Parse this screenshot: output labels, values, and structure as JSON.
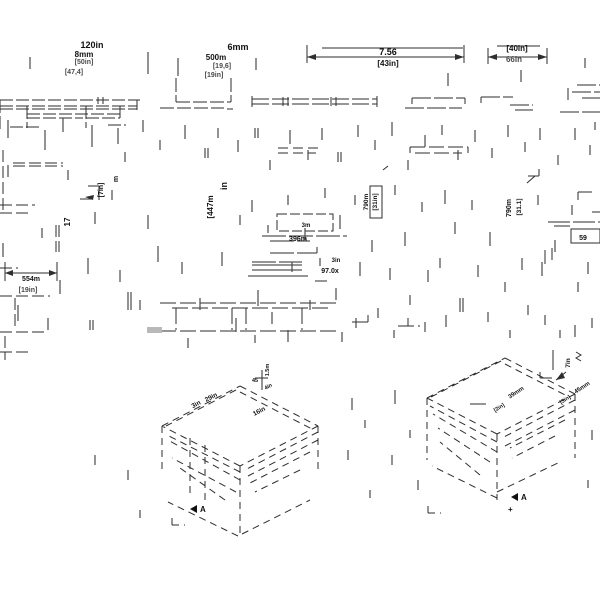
{
  "drawing": {
    "type": "cad-dimension-drawing",
    "background": "#ffffff",
    "line_color": "#2e2e2e",
    "gray_line_color": "#9a9a9a",
    "text_color": "#111111",
    "labels": {
      "a": [
        "120in",
        "8mm",
        "[50in]",
        "[47,4]"
      ],
      "b": [
        "6mm",
        "500m",
        "[19,6]",
        "[19in]"
      ],
      "c": [
        "7.56",
        "[43in]"
      ],
      "d": [
        "[40in]",
        "66in"
      ],
      "e": [
        "17",
        "[7in]",
        "m"
      ],
      "g": [
        "[447m",
        "in"
      ],
      "h": [
        "3m",
        "396m"
      ],
      "i": [
        "3in",
        "97.0x"
      ],
      "j": [
        "790m",
        "[31in]"
      ],
      "k": [
        "790m",
        "[31.1]"
      ],
      "l": [
        "554m",
        "[19in]"
      ],
      "m": [
        "59"
      ],
      "iso_left": [
        "3in",
        "29in",
        "16in",
        "45",
        "4in",
        "1.5m"
      ],
      "iso_right": [
        "7in",
        "39mm",
        "45mm",
        "[3in]",
        "[2in]"
      ],
      "markers": [
        "A",
        "A",
        "+"
      ]
    }
  }
}
